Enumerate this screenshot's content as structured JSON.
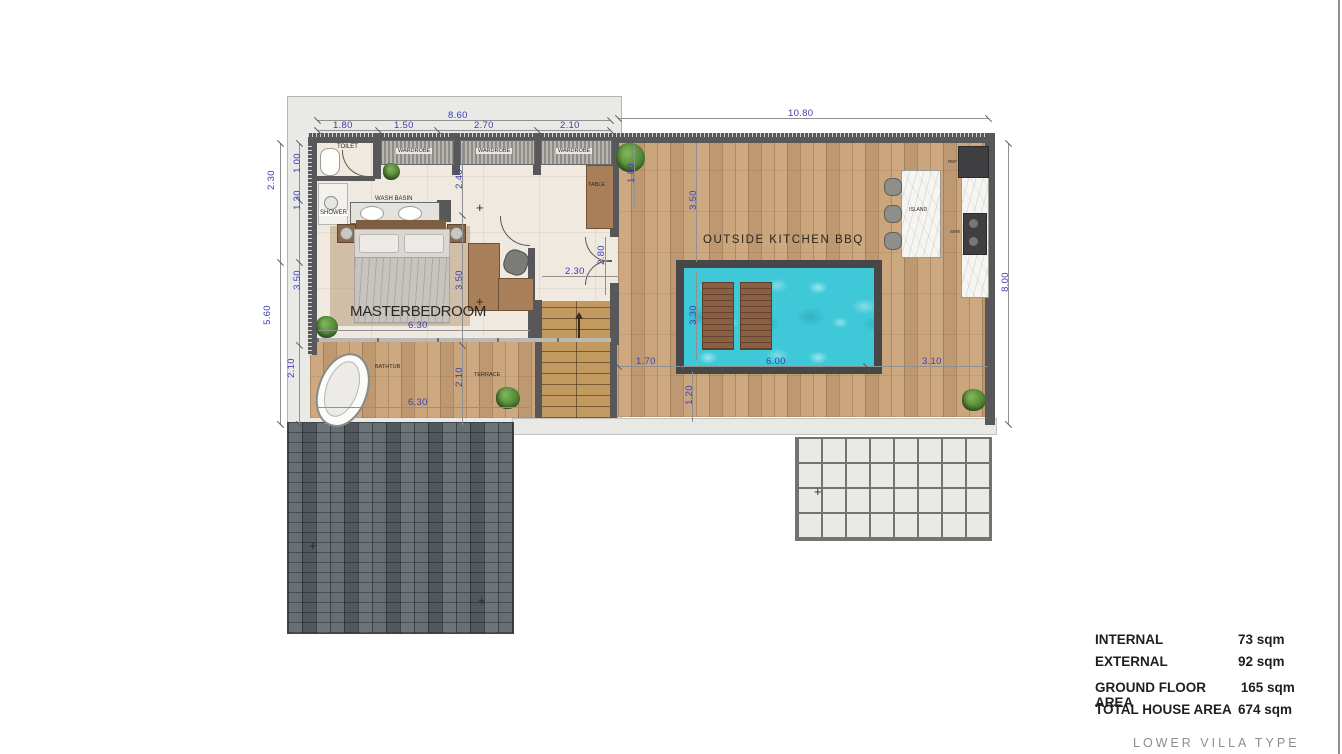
{
  "dims": {
    "t860": "8.60",
    "t180": "1.80",
    "t150": "1.50",
    "t270": "2.70",
    "t210": "2.10",
    "t1080": "10.80",
    "l230": "2.30",
    "l560": "5.60",
    "l100": "1.00",
    "l130": "1.30",
    "l350": "3.50",
    "l210": "2.10",
    "m240": "2.40",
    "b350": "3.50",
    "b630": "6.30",
    "ter630": "6.30",
    "ter210": "2.10",
    "m230": "2.30",
    "m280": "2.80",
    "d180": "1.80",
    "d350": "3.50",
    "p330": "3.30",
    "p120": "1.20",
    "d170": "1.70",
    "p600": "6.00",
    "d310": "3.10",
    "r800": "8.00"
  },
  "rooms": {
    "toilet": "TOILET",
    "wardrobe": "WARDROBE",
    "shower": "SHOWER",
    "wash_basin": "WASH BASIN",
    "master": "MASTERBEDROOM",
    "table": "TABLE",
    "outside_kitchen": "OUTSIDE  KITCHEN   BBQ",
    "island": "ISLAND",
    "ref": "REF",
    "sink": "SINK",
    "bathtub": "BATHTUB",
    "terrace": "TERRACE"
  },
  "legend": {
    "rows": [
      {
        "label": "INTERNAL",
        "value": "73 sqm"
      },
      {
        "label": "EXTERNAL",
        "value": "92 sqm"
      },
      {
        "label": "GROUND FLOOR AREA",
        "value": "165 sqm"
      },
      {
        "label": "TOTAL HOUSE AREA",
        "value": "674 sqm"
      }
    ],
    "footer": "LOWER  VILLA  TYPE"
  },
  "colors": {
    "dimension_text": "#3d3db5",
    "wall": "#58585a",
    "pool_water": "#3fc9d8",
    "deck_wood": "#c9a277",
    "interior_floor": "#efe9df",
    "patio_stone": "#5d666c"
  },
  "markers": {
    "cross": "+"
  }
}
